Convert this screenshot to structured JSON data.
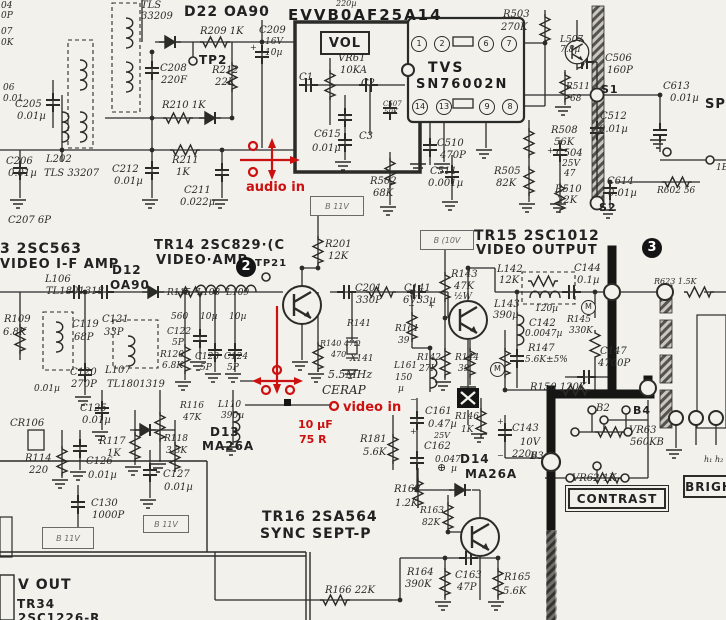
{
  "title": "TV chassis schematic scan — video IF / video output / sound section",
  "colors": {
    "paper": "#f2f1ec",
    "ink": "#2b2b28",
    "bold": "#161614",
    "annotation": "#cc1111"
  },
  "module_label": "EVVB0AF25A14",
  "ic": {
    "line1": "TVS",
    "line2": "SN76002N",
    "pins": [
      "1",
      "2",
      "6",
      "7",
      "14",
      "13",
      "9",
      "8"
    ]
  },
  "section_markers": [
    "2",
    "3"
  ],
  "boxes": {
    "vol": "VOL",
    "b11v_top": "B 11V",
    "b10v": "B (10V",
    "b11v_left": "B 11V",
    "b11v_mid": "B 11V",
    "contrast": "CONTRAST",
    "bright": "BRIGH"
  },
  "labels": [
    [
      "04",
      1,
      2,
      9,
      "h"
    ],
    [
      "0P",
      1,
      12,
      9,
      "h"
    ],
    [
      "07",
      1,
      28,
      9,
      "h"
    ],
    [
      "0K",
      1,
      39,
      9,
      "h"
    ],
    [
      "06",
      3,
      84,
      9,
      "h"
    ],
    [
      "0.01",
      3,
      95,
      9,
      "h"
    ],
    [
      "C205",
      15,
      100,
      10,
      "h"
    ],
    [
      "0.01µ",
      17,
      112,
      10,
      "h"
    ],
    [
      "C206",
      6,
      157,
      10,
      "h"
    ],
    [
      "0.01µ",
      8,
      169,
      10,
      "h"
    ],
    [
      "L202",
      46,
      155,
      10,
      "h"
    ],
    [
      "TLS 33207",
      44,
      169,
      10,
      "h"
    ],
    [
      "C207 6P",
      8,
      216,
      10,
      "h"
    ],
    [
      "TLS",
      141,
      1,
      10,
      "h"
    ],
    [
      "33209",
      141,
      12,
      10,
      "h"
    ],
    [
      "D22 OA90",
      184,
      5,
      14,
      "p"
    ],
    [
      "R209 1K",
      200,
      27,
      10,
      "h"
    ],
    [
      "TP2",
      199,
      54,
      12,
      "p"
    ],
    [
      "C208",
      160,
      64,
      10,
      "h"
    ],
    [
      "220F",
      161,
      76,
      10,
      "h"
    ],
    [
      "R212",
      212,
      66,
      10,
      "h"
    ],
    [
      "22K",
      215,
      78,
      10,
      "h"
    ],
    [
      "R210 1K",
      162,
      101,
      10,
      "h"
    ],
    [
      "C212",
      112,
      165,
      10,
      "h"
    ],
    [
      "0.01µ",
      114,
      177,
      10,
      "h"
    ],
    [
      "R211",
      172,
      156,
      10,
      "h"
    ],
    [
      "1K",
      176,
      168,
      10,
      "h"
    ],
    [
      "C211",
      184,
      186,
      10,
      "h"
    ],
    [
      "0.022µ",
      180,
      198,
      10,
      "h"
    ],
    [
      "C209",
      259,
      26,
      10,
      "h"
    ],
    [
      "16V",
      265,
      38,
      9,
      "h"
    ],
    [
      "10µ",
      265,
      49,
      9,
      "h"
    ],
    [
      "VR61",
      338,
      54,
      10,
      "h"
    ],
    [
      "10KA",
      340,
      66,
      10,
      "h"
    ],
    [
      "C1",
      299,
      73,
      10,
      "h"
    ],
    [
      "C2",
      361,
      79,
      10,
      "h"
    ],
    [
      "C3",
      359,
      132,
      10,
      "h"
    ],
    [
      "C615",
      314,
      130,
      10,
      "h"
    ],
    [
      "0.01µ",
      312,
      144,
      10,
      "h"
    ],
    [
      "C507",
      383,
      101,
      7,
      "h"
    ],
    [
      "50K",
      384,
      109,
      7,
      "h"
    ],
    [
      "C510",
      437,
      139,
      10,
      "h"
    ],
    [
      "470P",
      440,
      151,
      10,
      "h"
    ],
    [
      "C511",
      430,
      167,
      10,
      "h"
    ],
    [
      "0.001µ",
      428,
      179,
      10,
      "h"
    ],
    [
      "R502",
      370,
      177,
      10,
      "h"
    ],
    [
      "68K",
      373,
      189,
      10,
      "h"
    ],
    [
      "R503",
      503,
      10,
      10,
      "h"
    ],
    [
      "270K",
      501,
      23,
      10,
      "h"
    ],
    [
      "L507",
      560,
      36,
      9,
      "h"
    ],
    [
      "7.8µ",
      560,
      46,
      9,
      "h"
    ],
    [
      "C506",
      605,
      54,
      10,
      "h"
    ],
    [
      "160P",
      607,
      66,
      10,
      "h"
    ],
    [
      "S1",
      601,
      84,
      11,
      "p"
    ],
    [
      "R511",
      566,
      83,
      9,
      "h"
    ],
    [
      "68",
      570,
      95,
      9,
      "h"
    ],
    [
      "C613",
      663,
      82,
      10,
      "h"
    ],
    [
      "0.01µ",
      670,
      94,
      10,
      "h"
    ],
    [
      "SP",
      705,
      98,
      13,
      "p"
    ],
    [
      "C512",
      600,
      112,
      10,
      "h"
    ],
    [
      "0.01µ",
      599,
      125,
      10,
      "h"
    ],
    [
      "R508",
      551,
      126,
      10,
      "h"
    ],
    [
      "56K",
      554,
      138,
      10,
      "h"
    ],
    [
      "C504",
      556,
      149,
      10,
      "h"
    ],
    [
      "25V",
      562,
      160,
      9,
      "h"
    ],
    [
      "47",
      564,
      170,
      9,
      "h"
    ],
    [
      "R505",
      494,
      167,
      10,
      "h"
    ],
    [
      "82K",
      496,
      179,
      10,
      "h"
    ],
    [
      "R510",
      555,
      185,
      10,
      "h"
    ],
    [
      "22K",
      557,
      196,
      10,
      "h"
    ],
    [
      "C614",
      607,
      177,
      10,
      "h"
    ],
    [
      "0.01µ",
      608,
      189,
      10,
      "h"
    ],
    [
      "R602 56",
      657,
      187,
      9,
      "h"
    ],
    [
      "S2",
      599,
      202,
      11,
      "p"
    ],
    [
      "1E",
      716,
      164,
      9,
      "h"
    ],
    [
      "220µ",
      336,
      0,
      8,
      "h"
    ],
    [
      "3 2SC563",
      0,
      242,
      14,
      "p"
    ],
    [
      "VIDEO I-F AMP",
      0,
      258,
      13,
      "p"
    ],
    [
      "TR14 2SC829·(C",
      154,
      239,
      13,
      "p"
    ],
    [
      "VIDEO·AMP",
      156,
      254,
      13,
      "p"
    ],
    [
      "D12",
      112,
      264,
      12,
      "p"
    ],
    [
      "OA90",
      110,
      279,
      12,
      "p"
    ],
    [
      "L106",
      45,
      275,
      10,
      "h"
    ],
    [
      "TL1801318",
      46,
      287,
      10,
      "h"
    ],
    [
      "TP21",
      255,
      259,
      10,
      "p"
    ],
    [
      "R115",
      167,
      289,
      9,
      "h"
    ],
    [
      "560",
      171,
      313,
      9,
      "h"
    ],
    [
      "L108",
      197,
      289,
      9,
      "h"
    ],
    [
      "10µ",
      200,
      313,
      9,
      "h"
    ],
    [
      "L109",
      226,
      289,
      9,
      "h"
    ],
    [
      "10µ",
      229,
      313,
      9,
      "h"
    ],
    [
      "C122",
      167,
      328,
      9,
      "h"
    ],
    [
      "5P",
      172,
      339,
      9,
      "h"
    ],
    [
      "R120",
      160,
      351,
      9,
      "h"
    ],
    [
      "6.8K",
      162,
      362,
      9,
      "h"
    ],
    [
      "C123",
      195,
      353,
      9,
      "h"
    ],
    [
      "5P",
      200,
      364,
      9,
      "h"
    ],
    [
      "C124",
      224,
      353,
      9,
      "h"
    ],
    [
      "5P",
      227,
      364,
      9,
      "h"
    ],
    [
      "R109",
      4,
      315,
      10,
      "h"
    ],
    [
      "6.8K",
      3,
      328,
      10,
      "h"
    ],
    [
      "C119",
      72,
      320,
      10,
      "h"
    ],
    [
      "68P",
      74,
      333,
      10,
      "h"
    ],
    [
      "C121",
      102,
      315,
      10,
      "h"
    ],
    [
      "33P",
      104,
      328,
      10,
      "h"
    ],
    [
      "C120",
      70,
      368,
      10,
      "h"
    ],
    [
      "270P",
      71,
      380,
      10,
      "h"
    ],
    [
      "L107",
      105,
      366,
      10,
      "h"
    ],
    [
      "TL1801319",
      107,
      380,
      10,
      "h"
    ],
    [
      "0.01µ",
      34,
      385,
      9,
      "h"
    ],
    [
      "R116",
      180,
      402,
      9,
      "h"
    ],
    [
      "47K",
      183,
      414,
      9,
      "h"
    ],
    [
      "L110",
      218,
      401,
      9,
      "h"
    ],
    [
      "390µ",
      221,
      412,
      9,
      "h"
    ],
    [
      "D13",
      210,
      426,
      12,
      "p"
    ],
    [
      "MA26A",
      202,
      440,
      12,
      "p"
    ],
    [
      "R118",
      164,
      435,
      9,
      "h"
    ],
    [
      "3.3K",
      166,
      447,
      9,
      "h"
    ],
    [
      "CR106",
      10,
      419,
      10,
      "h"
    ],
    [
      "R114",
      25,
      454,
      10,
      "h"
    ],
    [
      "220",
      29,
      466,
      10,
      "h"
    ],
    [
      "C125",
      80,
      404,
      10,
      "h"
    ],
    [
      "0.01µ",
      82,
      416,
      10,
      "h"
    ],
    [
      "R117",
      99,
      437,
      10,
      "h"
    ],
    [
      "1K",
      107,
      449,
      10,
      "h"
    ],
    [
      "C126",
      86,
      457,
      10,
      "h"
    ],
    [
      "0.01µ",
      88,
      471,
      10,
      "h"
    ],
    [
      "C127",
      163,
      470,
      10,
      "h"
    ],
    [
      "0.01µ",
      164,
      483,
      10,
      "h"
    ],
    [
      "C130",
      91,
      499,
      10,
      "h"
    ],
    [
      "1000P",
      92,
      511,
      10,
      "h"
    ],
    [
      "V OUT",
      18,
      578,
      14,
      "p"
    ],
    [
      "TR34",
      17,
      598,
      12,
      "p"
    ],
    [
      "2SC1226-R",
      18,
      612,
      12,
      "p"
    ],
    [
      "R201",
      325,
      240,
      10,
      "h"
    ],
    [
      "12K",
      328,
      252,
      10,
      "h"
    ],
    [
      "C201",
      355,
      284,
      10,
      "h"
    ],
    [
      "330P",
      356,
      296,
      10,
      "h"
    ],
    [
      "R141",
      347,
      320,
      9,
      "h"
    ],
    [
      "R140 47Ω",
      320,
      340,
      8,
      "h"
    ],
    [
      "470",
      331,
      351,
      8,
      "h"
    ],
    [
      "X141",
      350,
      355,
      9,
      "h"
    ],
    [
      "5.5MHz",
      328,
      369,
      11,
      "h"
    ],
    [
      "CERAP",
      322,
      384,
      12,
      "h"
    ],
    [
      "C141",
      404,
      284,
      10,
      "h"
    ],
    [
      "6V33µ",
      403,
      296,
      10,
      "h"
    ],
    [
      "−",
      408,
      302,
      8,
      "h"
    ],
    [
      "+",
      428,
      302,
      8,
      "h"
    ],
    [
      "R143",
      451,
      270,
      10,
      "h"
    ],
    [
      "47K",
      454,
      282,
      10,
      "h"
    ],
    [
      "½W",
      454,
      293,
      9,
      "h"
    ],
    [
      "R161",
      395,
      325,
      9,
      "h"
    ],
    [
      "39",
      398,
      337,
      9,
      "h"
    ],
    [
      "R142",
      417,
      354,
      9,
      "h"
    ],
    [
      "27K",
      419,
      365,
      9,
      "h"
    ],
    [
      "L161",
      394,
      362,
      9,
      "h"
    ],
    [
      "150",
      395,
      374,
      9,
      "h"
    ],
    [
      "µ",
      398,
      385,
      9,
      "h"
    ],
    [
      "R144",
      455,
      354,
      9,
      "h"
    ],
    [
      "39",
      458,
      365,
      9,
      "h"
    ],
    [
      "TR15 2SC1012",
      474,
      229,
      14,
      "p"
    ],
    [
      "VIDEO OUTPUT",
      476,
      244,
      13,
      "p"
    ],
    [
      "L142",
      497,
      265,
      10,
      "h"
    ],
    [
      "12K",
      499,
      276,
      10,
      "h"
    ],
    [
      "C144",
      574,
      264,
      10,
      "h"
    ],
    [
      "0.1µ",
      577,
      276,
      10,
      "h"
    ],
    [
      "L143",
      494,
      300,
      10,
      "h"
    ],
    [
      "390µ",
      493,
      311,
      10,
      "h"
    ],
    [
      "120µ",
      535,
      305,
      9,
      "h"
    ],
    [
      "C142",
      529,
      319,
      10,
      "h"
    ],
    [
      "0.0047µ",
      525,
      330,
      9,
      "h"
    ],
    [
      "R145",
      567,
      316,
      9,
      "h"
    ],
    [
      "330K",
      569,
      327,
      9,
      "h"
    ],
    [
      "R147",
      528,
      344,
      10,
      "h"
    ],
    [
      "5.6K±5%",
      525,
      356,
      9,
      "h"
    ],
    [
      "C147",
      600,
      347,
      10,
      "h"
    ],
    [
      "4700P",
      598,
      359,
      10,
      "h"
    ],
    [
      "R150 120K",
      530,
      383,
      10,
      "h"
    ],
    [
      "R623 1.5K",
      654,
      278,
      8,
      "h"
    ],
    [
      "M",
      581,
      300,
      8,
      "pinlb"
    ],
    [
      "M",
      490,
      362,
      8,
      "pinlb"
    ],
    [
      "C161",
      425,
      407,
      10,
      "h"
    ],
    [
      "0.47µ",
      428,
      420,
      10,
      "h"
    ],
    [
      "−",
      410,
      396,
      8,
      "h"
    ],
    [
      "+",
      410,
      428,
      8,
      "h"
    ],
    [
      "R146",
      455,
      413,
      9,
      "h"
    ],
    [
      "1K",
      461,
      426,
      9,
      "h"
    ],
    [
      "25V",
      434,
      432,
      8,
      "h"
    ],
    [
      "C162",
      424,
      442,
      10,
      "h"
    ],
    [
      "0.047",
      435,
      456,
      9,
      "h"
    ],
    [
      "⊕",
      437,
      462,
      11,
      "h"
    ],
    [
      "µ",
      451,
      465,
      9,
      "h"
    ],
    [
      "D14",
      460,
      453,
      12,
      "p"
    ],
    [
      "MA26A",
      465,
      468,
      12,
      "p"
    ],
    [
      "C143",
      512,
      424,
      10,
      "h"
    ],
    [
      "10V",
      520,
      438,
      10,
      "h"
    ],
    [
      "220µ",
      512,
      450,
      10,
      "h"
    ],
    [
      "+",
      497,
      418,
      8,
      "h"
    ],
    [
      "−",
      497,
      452,
      8,
      "h"
    ],
    [
      "B2",
      596,
      404,
      10,
      "h"
    ],
    [
      "B4",
      633,
      405,
      11,
      "p"
    ],
    [
      "B3",
      530,
      452,
      10,
      "h"
    ],
    [
      "VR63",
      629,
      426,
      10,
      "h"
    ],
    [
      "560KB",
      630,
      438,
      10,
      "h"
    ],
    [
      "VR62 1K",
      572,
      474,
      10,
      "h"
    ],
    [
      "h₁",
      704,
      456,
      8,
      "h"
    ],
    [
      "h₂",
      715,
      456,
      8,
      "h"
    ],
    [
      "R181",
      360,
      435,
      10,
      "h"
    ],
    [
      "5.6K",
      363,
      448,
      10,
      "h"
    ],
    [
      "R162",
      394,
      485,
      10,
      "h"
    ],
    [
      "1.2K",
      395,
      499,
      10,
      "h"
    ],
    [
      "R163",
      420,
      507,
      9,
      "h"
    ],
    [
      "82K",
      422,
      519,
      9,
      "h"
    ],
    [
      "TR16 2SA564",
      262,
      510,
      14,
      "p"
    ],
    [
      "SYNC SEPT-P",
      260,
      527,
      14,
      "p"
    ],
    [
      "R166 22K",
      325,
      586,
      10,
      "h"
    ],
    [
      "R164",
      407,
      568,
      10,
      "h"
    ],
    [
      "390K",
      405,
      580,
      10,
      "h"
    ],
    [
      "C163",
      455,
      571,
      10,
      "h"
    ],
    [
      "47P",
      457,
      583,
      10,
      "h"
    ],
    [
      "R165",
      504,
      573,
      10,
      "h"
    ],
    [
      "5.6K",
      503,
      587,
      10,
      "h"
    ],
    [
      "+",
      250,
      44,
      8,
      "h"
    ],
    [
      "+",
      547,
      147,
      8,
      "h"
    ],
    [
      "audio in",
      246,
      181,
      13,
      "red"
    ],
    [
      "video in",
      343,
      401,
      13,
      "red"
    ],
    [
      "10 µF",
      298,
      419,
      11,
      "red"
    ],
    [
      "75 R",
      299,
      434,
      11,
      "red"
    ]
  ]
}
